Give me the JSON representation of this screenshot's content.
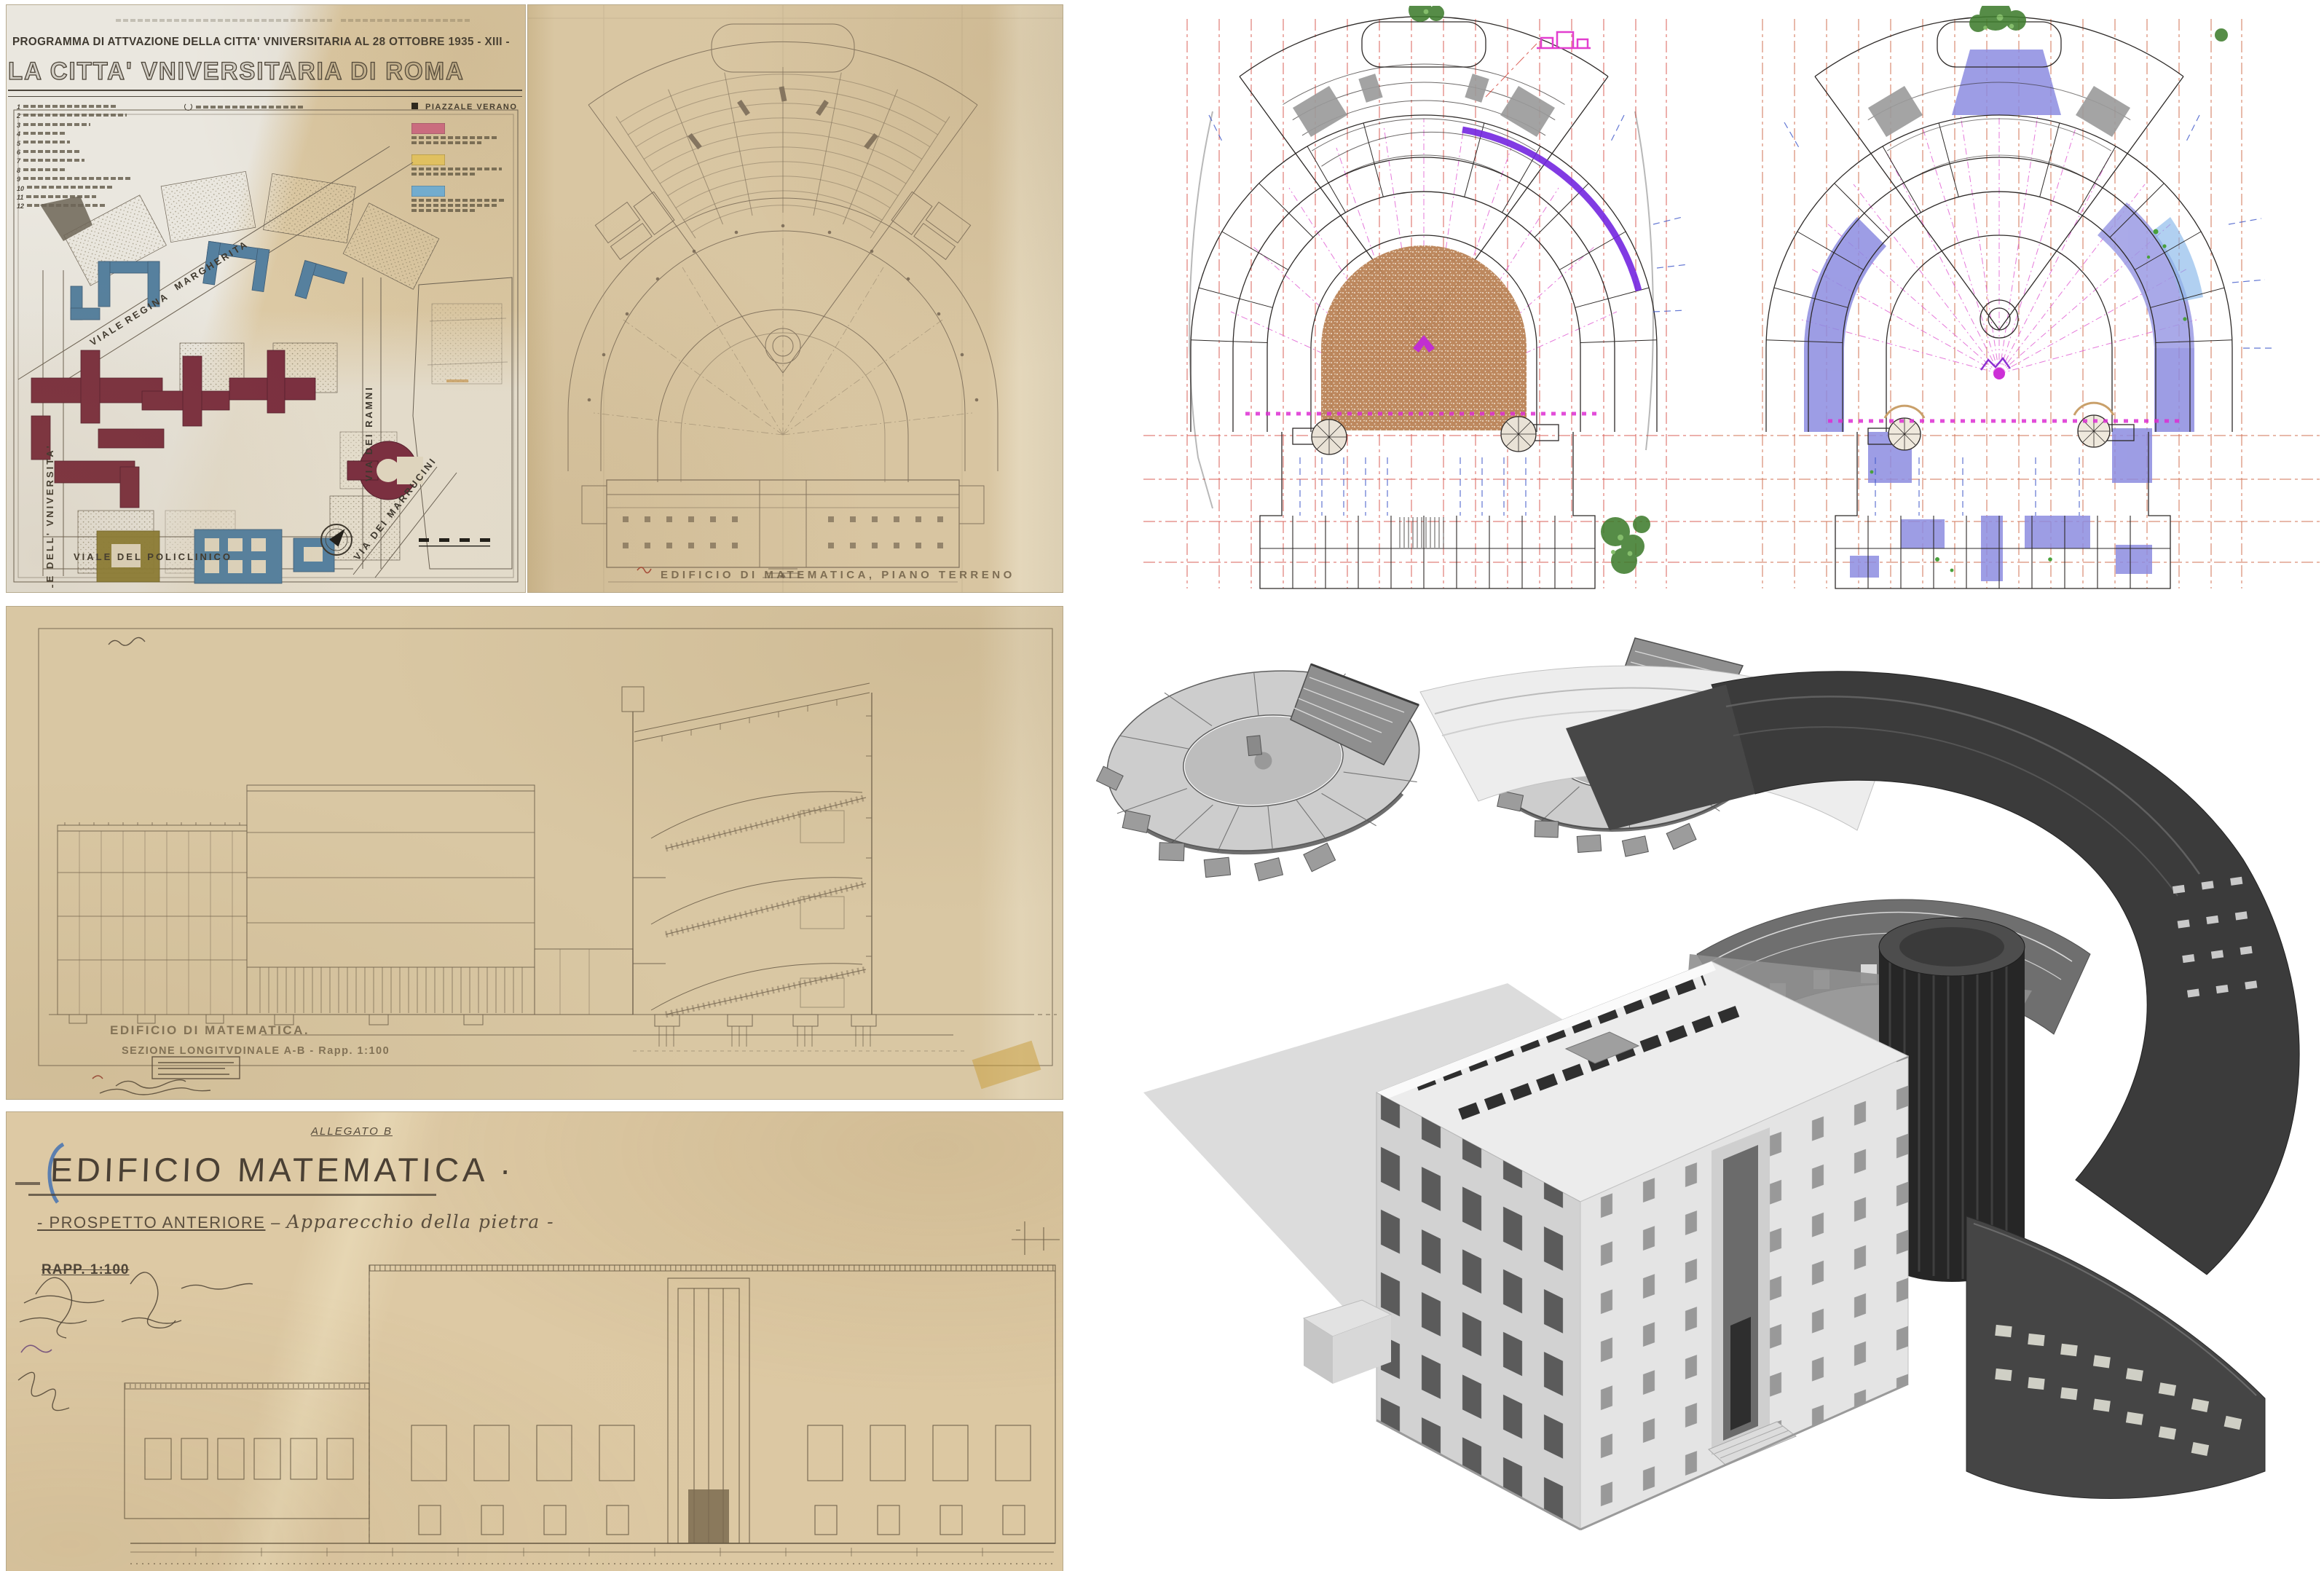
{
  "page": {
    "bg": "#ffffff"
  },
  "site_plan": {
    "title_line1": "PROGRAMMA DI ATTVAZIONE DELLA CITTA' VNIVERSITARIA AL 28 OTTOBRE 1935 - XIII -",
    "title_line2": "LA CITTA' VNIVERSITARIA DI ROMA",
    "legend_numbers": [
      "1",
      "2",
      "3",
      "4",
      "5",
      "6",
      "7",
      "8",
      "9",
      "10",
      "11",
      "12"
    ],
    "piazzale_label": "PIAZZALE VERANO",
    "legend_swatches": [
      "#d06b85",
      "#e7c763",
      "#6fb0d9"
    ],
    "streets": {
      "viale": "VIALE",
      "regina": "REGINA",
      "margherita": "MARGHERITA",
      "universita": "VIALE  DELL' VNIVERSITA'",
      "policlinico": "VIALE   DEL   POLICLINICO",
      "marrucini": "VIA DEI MARRUCINI",
      "ramni": "VIA DEI RAMNI"
    },
    "building_colors": {
      "maroon": "#7b3040",
      "blue": "#55809f",
      "olive": "#8b7c33"
    }
  },
  "ground_plan": {
    "caption": "EDIFICIO DI MATEMATICA, PIANO TERRENO"
  },
  "section": {
    "caption_line1": "EDIFICIO DI MATEMATICA.",
    "caption_line2": "SEZIONE LONGITVDINALE A-B  -  Rapp. 1:100"
  },
  "elevation": {
    "allegato": "ALLEGATO B",
    "title": "EDIFICIO MATEMATICA ·",
    "subtitle_1": "- PROSPETTO ANTERIORE",
    "subtitle_sep": "–",
    "subtitle_2": "Apparecchio della pietra -",
    "scale_label": "RAPP. 1:100"
  },
  "cad_plans": {
    "colors": {
      "grid_red": "#d23b2f",
      "radial_magenta": "#e36bd6",
      "accent_purple": "#7326e0",
      "tick_blue": "#3b55c8",
      "fill_periwinkle": "#8c8ce0",
      "apse_brown": "#b98256",
      "tree_green": "#3f7d2e"
    }
  },
  "model_3d": {
    "colors": {
      "front_light": "#ececec",
      "mid_gray": "#9a9a9a",
      "rear_dark": "#3b3b3b",
      "shadow": "#dcdcdc"
    }
  }
}
